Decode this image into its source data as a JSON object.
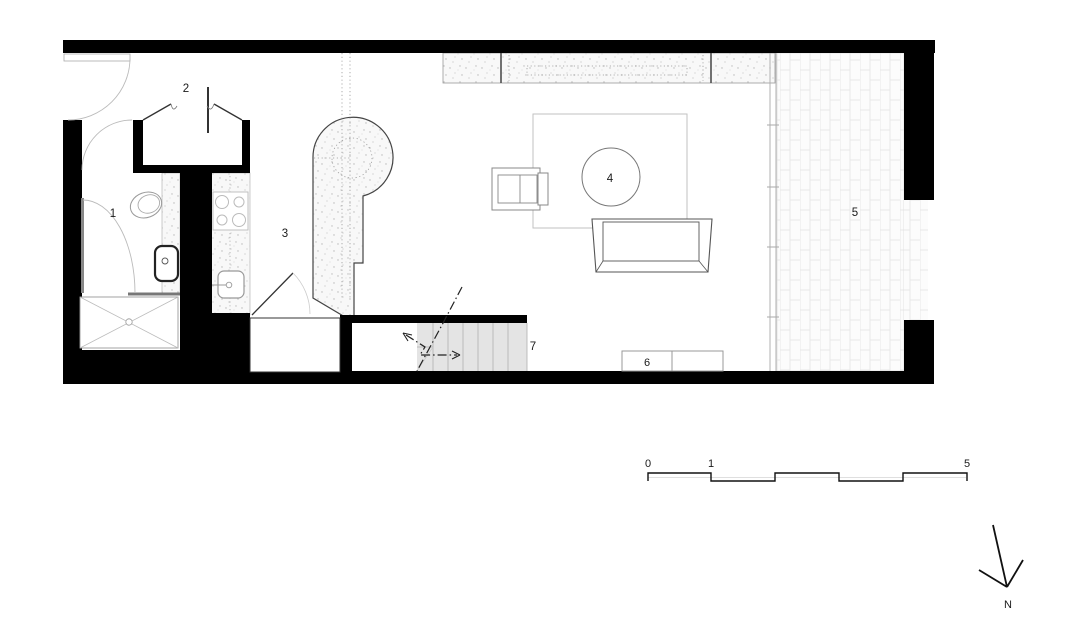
{
  "drawing": {
    "room_labels": [
      {
        "label": "1"
      },
      {
        "label": "2"
      },
      {
        "label": "3"
      },
      {
        "label": "4"
      },
      {
        "label": "5"
      },
      {
        "label": "6"
      },
      {
        "label": "7"
      }
    ],
    "scale_bar": {
      "labels": [
        "0",
        "1",
        "5"
      ]
    },
    "north_arrow": {
      "label": "N"
    }
  },
  "colors": {
    "wall": "#000000",
    "stair_fill": "#e4e4e4",
    "label_text": "#1a1a1a"
  }
}
